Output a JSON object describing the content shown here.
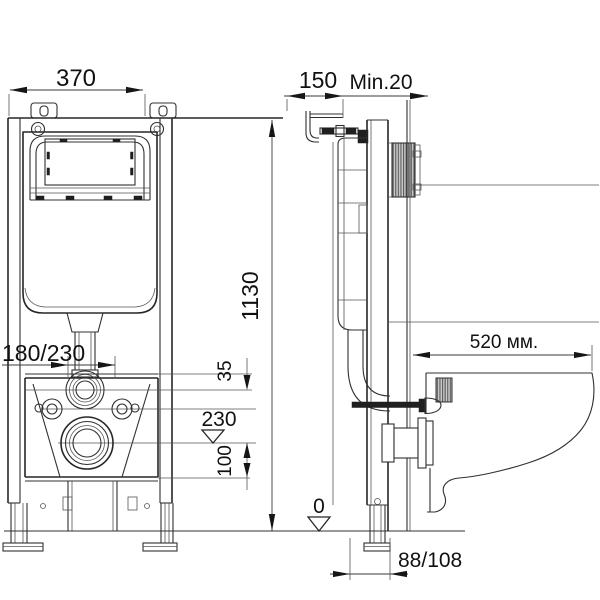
{
  "drawing": {
    "type": "technical-installation-diagram",
    "subject": "wall-hung toilet concealed cistern frame, front and side views",
    "dimensions": {
      "frame_width": "370",
      "frame_depth": "150",
      "min_wall_thickness": "Min.20",
      "frame_height": "1130",
      "flush_pipe_offset": "180/230",
      "inlet_offset": "35",
      "drain_axis_height": "230",
      "drain_bottom_offset": "100",
      "floor_level": "0",
      "outlet_offset": "88/108",
      "bowl_depth": "520 мм."
    },
    "line_color": "#262626",
    "background_color": "#ffffff",
    "hatch_color": "#8f8f8f"
  }
}
